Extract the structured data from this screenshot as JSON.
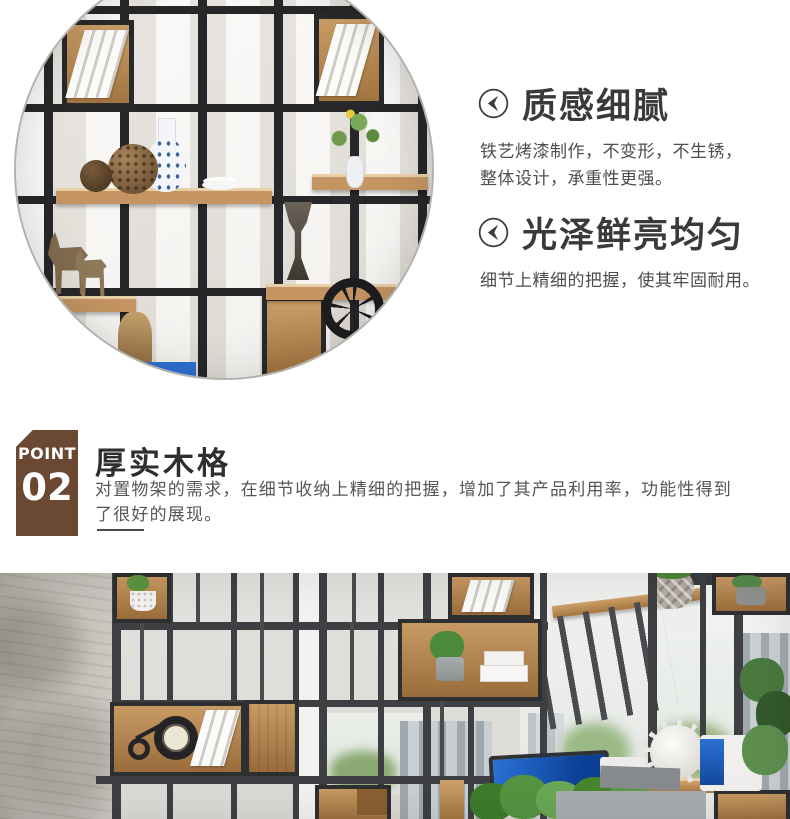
{
  "features": [
    {
      "icon": "circle-back-arrow-icon",
      "title": "质感细腻",
      "description": "铁艺烤漆制作，不变形，不生锈，整体设计，承重性更强。"
    },
    {
      "icon": "circle-back-arrow-icon",
      "title": "光泽鲜亮均匀",
      "description": "细节上精细的把握，使其牢固耐用。"
    }
  ],
  "point_section": {
    "badge_label": "POINT",
    "badge_number": "02",
    "title": "厚实木格",
    "description": "对置物架的需求，在细节收纳上精细的把握，增加了其产品利用率，功能性得到了很好的展现。"
  },
  "colors": {
    "badge_brown": "#6b4832",
    "heading_text": "#2e2e2e",
    "body_text": "#4d4d4d",
    "shelf_frame_dark": "#27272a",
    "banner_frame_gray": "#3e3f42",
    "wood_tan": "#c89a63",
    "monitor_screen_blue": "#1f66c2"
  }
}
